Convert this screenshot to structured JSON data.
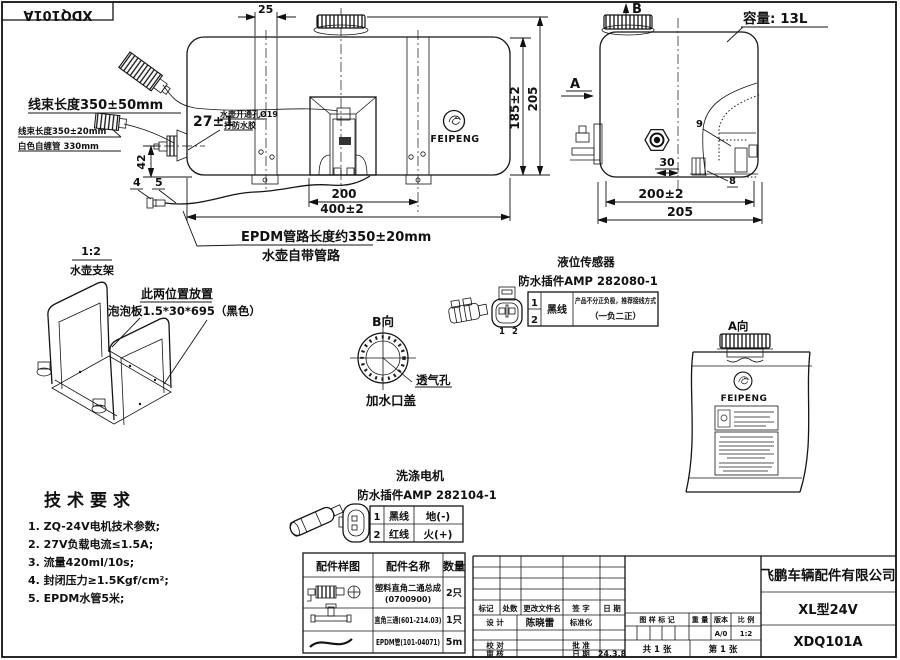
{
  "frame": {
    "corner_code": "XDQ101A"
  },
  "front_view": {
    "dim_25": "25",
    "harness_label_1": "线束长度350±50mm",
    "harness_label_2": "线束长度350±20mm",
    "harness_label_3": "白色自缠管 330mm",
    "dim_27": "27±1",
    "hole_note_1": "水壶开通孔Ø19",
    "hole_note_2": "打防水胶",
    "dim_42": "42",
    "balloon_4": "4",
    "balloon_5": "5",
    "dim_200": "200",
    "dim_400": "400±2",
    "dim_185": "185±2",
    "dim_205": "205",
    "logo": "FEIPENG",
    "epdm_note_1": "EPDM管路长度约350±20mm",
    "epdm_note_2": "水壶自带管路"
  },
  "side_view": {
    "view_b": "B",
    "view_a": "A",
    "capacity": "容量: 13L",
    "balloon_9": "9",
    "balloon_8": "8",
    "dim_30": "30",
    "dim_200": "200±2",
    "dim_205": "205"
  },
  "bracket_view": {
    "scale": "1:2",
    "name": "水壶支架",
    "note_1": "此两位置放置",
    "note_2": "泡泡板1.5*30*695（黑色）"
  },
  "b_view": {
    "title": "B向",
    "vent_label": "透气孔",
    "cap_label": "加水口盖"
  },
  "level_sensor": {
    "title": "液位传感器",
    "connector": "防水插件AMP 282080-1",
    "pin_left": "1",
    "pin_right": "2",
    "row1_no": "1",
    "row2_no": "2",
    "wire": "黑线",
    "note_1": "产品不分正负极，推荐接线方式",
    "note_2": "（一负二正）"
  },
  "a_view": {
    "title": "A向",
    "logo": "FEIPENG"
  },
  "washer_motor": {
    "title": "洗涤电机",
    "connector": "防水插件AMP 282104-1",
    "rows": [
      {
        "no": "1",
        "wire": "黑线",
        "terminal": "地(-)"
      },
      {
        "no": "2",
        "wire": "红线",
        "terminal": "火(+)"
      }
    ]
  },
  "tech_requirements": {
    "title": "技术要求",
    "items": [
      "1. ZQ-24V电机技术参数;",
      "2. 27V负载电流≤1.5A;",
      "3. 流量420ml/10s;",
      "4. 封闭压力≥1.5Kgf/cm²;",
      "5. EPDM水管5米;"
    ]
  },
  "parts_table": {
    "col_sample": "配件样图",
    "col_name": "配件名称",
    "col_qty": "数量",
    "rows": [
      {
        "name": "塑料直角二通总成",
        "code": "(0700900)",
        "qty": "2只"
      },
      {
        "name": "直角三通(601-214.03)",
        "code": "",
        "qty": "1只"
      },
      {
        "name": "EPDM管(101-04071)",
        "code": "",
        "qty": "5m"
      }
    ]
  },
  "title_block": {
    "company": "飞鹏车辆配件有限公司",
    "model": "XL型24V",
    "drawing_no": "XDQ101A",
    "rev_mark": "标记",
    "rev_count": "处数",
    "rev_file": "更改文件名",
    "rev_sign": "签 字",
    "rev_date": "日 期",
    "design": "设 计",
    "designer": "陈晓雷",
    "standard": "标准化",
    "check": "校 对",
    "approve": "批 准",
    "audit": "审 核",
    "date_label": "日 期",
    "date_value": "24.3.8",
    "mark_label": "图 样 标 记",
    "weight_label": "重 量",
    "version_label": "版本",
    "scale_label": "比 例",
    "version_value": "A/0",
    "scale_value": "1:2",
    "sheet_total": "共 1 张",
    "sheet_no": "第 1 张"
  }
}
